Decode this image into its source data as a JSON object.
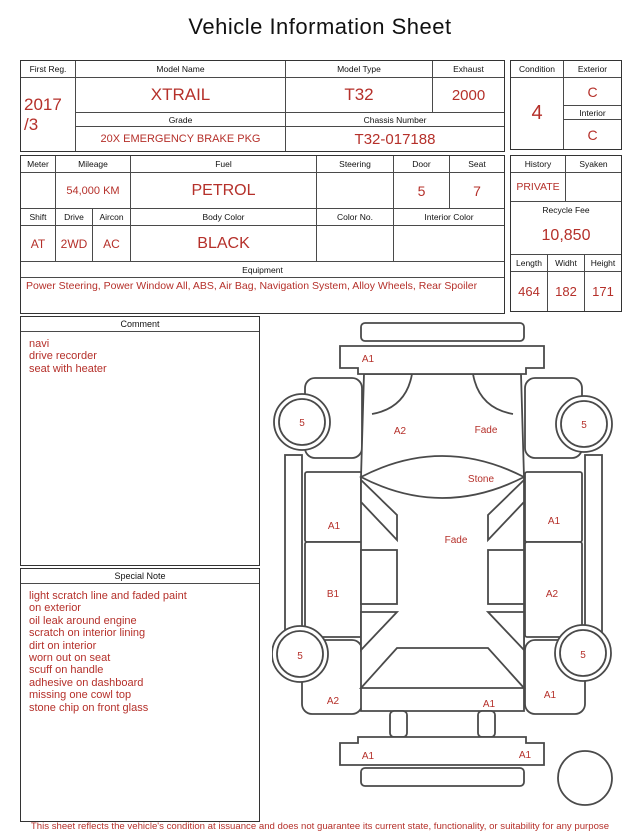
{
  "title": "Vehicle Information Sheet",
  "colors": {
    "accent_red": "#b5302a",
    "border": "#4a4a4a"
  },
  "table1": {
    "first_reg": {
      "label": "First Reg.",
      "value_line1": "2017",
      "value_line2": "/3"
    },
    "model_name": {
      "label": "Model Name",
      "value": "XTRAIL"
    },
    "model_type": {
      "label": "Model Type",
      "value": "T32"
    },
    "exhaust": {
      "label": "Exhaust",
      "value": "2000"
    },
    "grade": {
      "label": "Grade",
      "value": "20X EMERGENCY BRAKE PKG"
    },
    "chassis_number": {
      "label": "Chassis Number",
      "value": "T32-017188"
    },
    "condition": {
      "label": "Condition",
      "value": "4"
    },
    "exterior": {
      "label": "Exterior",
      "value": "C"
    },
    "interior": {
      "label": "Interior",
      "value": "C"
    }
  },
  "table2": {
    "meter": {
      "label": "Meter",
      "value": ""
    },
    "mileage": {
      "label": "Mileage",
      "value": "54,000 KM"
    },
    "fuel": {
      "label": "Fuel",
      "value": "PETROL"
    },
    "steering": {
      "label": "Steering",
      "value": ""
    },
    "door": {
      "label": "Door",
      "value": "5"
    },
    "seat": {
      "label": "Seat",
      "value": "7"
    },
    "shift": {
      "label": "Shift",
      "value": "AT"
    },
    "drive": {
      "label": "Drive",
      "value": "2WD"
    },
    "aircon": {
      "label": "Aircon",
      "value": "AC"
    },
    "body_color": {
      "label": "Body Color",
      "value": "BLACK"
    },
    "color_no": {
      "label": "Color No.",
      "value": ""
    },
    "interior_color": {
      "label": "Interior Color",
      "value": ""
    },
    "equipment": {
      "label": "Equipment",
      "value": "Power Steering, Power Window  All, ABS, Air Bag, Navigation System, Alloy Wheels, Rear Spoiler"
    },
    "history": {
      "label": "History",
      "value": "PRIVATE"
    },
    "syaken": {
      "label": "Syaken",
      "value": ""
    },
    "recycle_fee": {
      "label": "Recycle Fee",
      "value": "10,850"
    },
    "length": {
      "label": "Length",
      "value": "464"
    },
    "width": {
      "label": "Widht",
      "value": "182"
    },
    "height": {
      "label": "Height",
      "value": "171"
    }
  },
  "comment": {
    "label": "Comment",
    "lines": [
      "navi",
      "drive recorder",
      "seat with heater"
    ]
  },
  "special_note": {
    "label": "Special Note",
    "lines": [
      "light scratch line and faded paint",
      "on exterior",
      "oil leak around engine",
      "scratch on interior lining",
      "dirt on interior",
      "worn out on seat",
      "scuff on handle",
      "adhesive on dashboard",
      "missing one cowl top",
      "stone chip on front glass"
    ]
  },
  "diagram": {
    "front_bumper": "A1",
    "front_wheel_left": "5",
    "front_wheel_right": "5",
    "hood": "A2",
    "hood_fade": "Fade",
    "windshield": "Stone",
    "front_door_left": "A1",
    "front_door_right": "A1",
    "roof": "Fade",
    "rear_door_left": "B1",
    "rear_door_right": "A2",
    "rear_wheel_left": "5",
    "rear_wheel_right": "5",
    "rear_fender_left": "A2",
    "rear_fender_right": "A1",
    "trunk": "A1",
    "rear_bumper_left": "A1",
    "rear_bumper_right": "A1"
  },
  "footer": "This sheet reflects the vehicle's condition at issuance and does not guarantee its current state, functionality, or suitability for any purpose"
}
